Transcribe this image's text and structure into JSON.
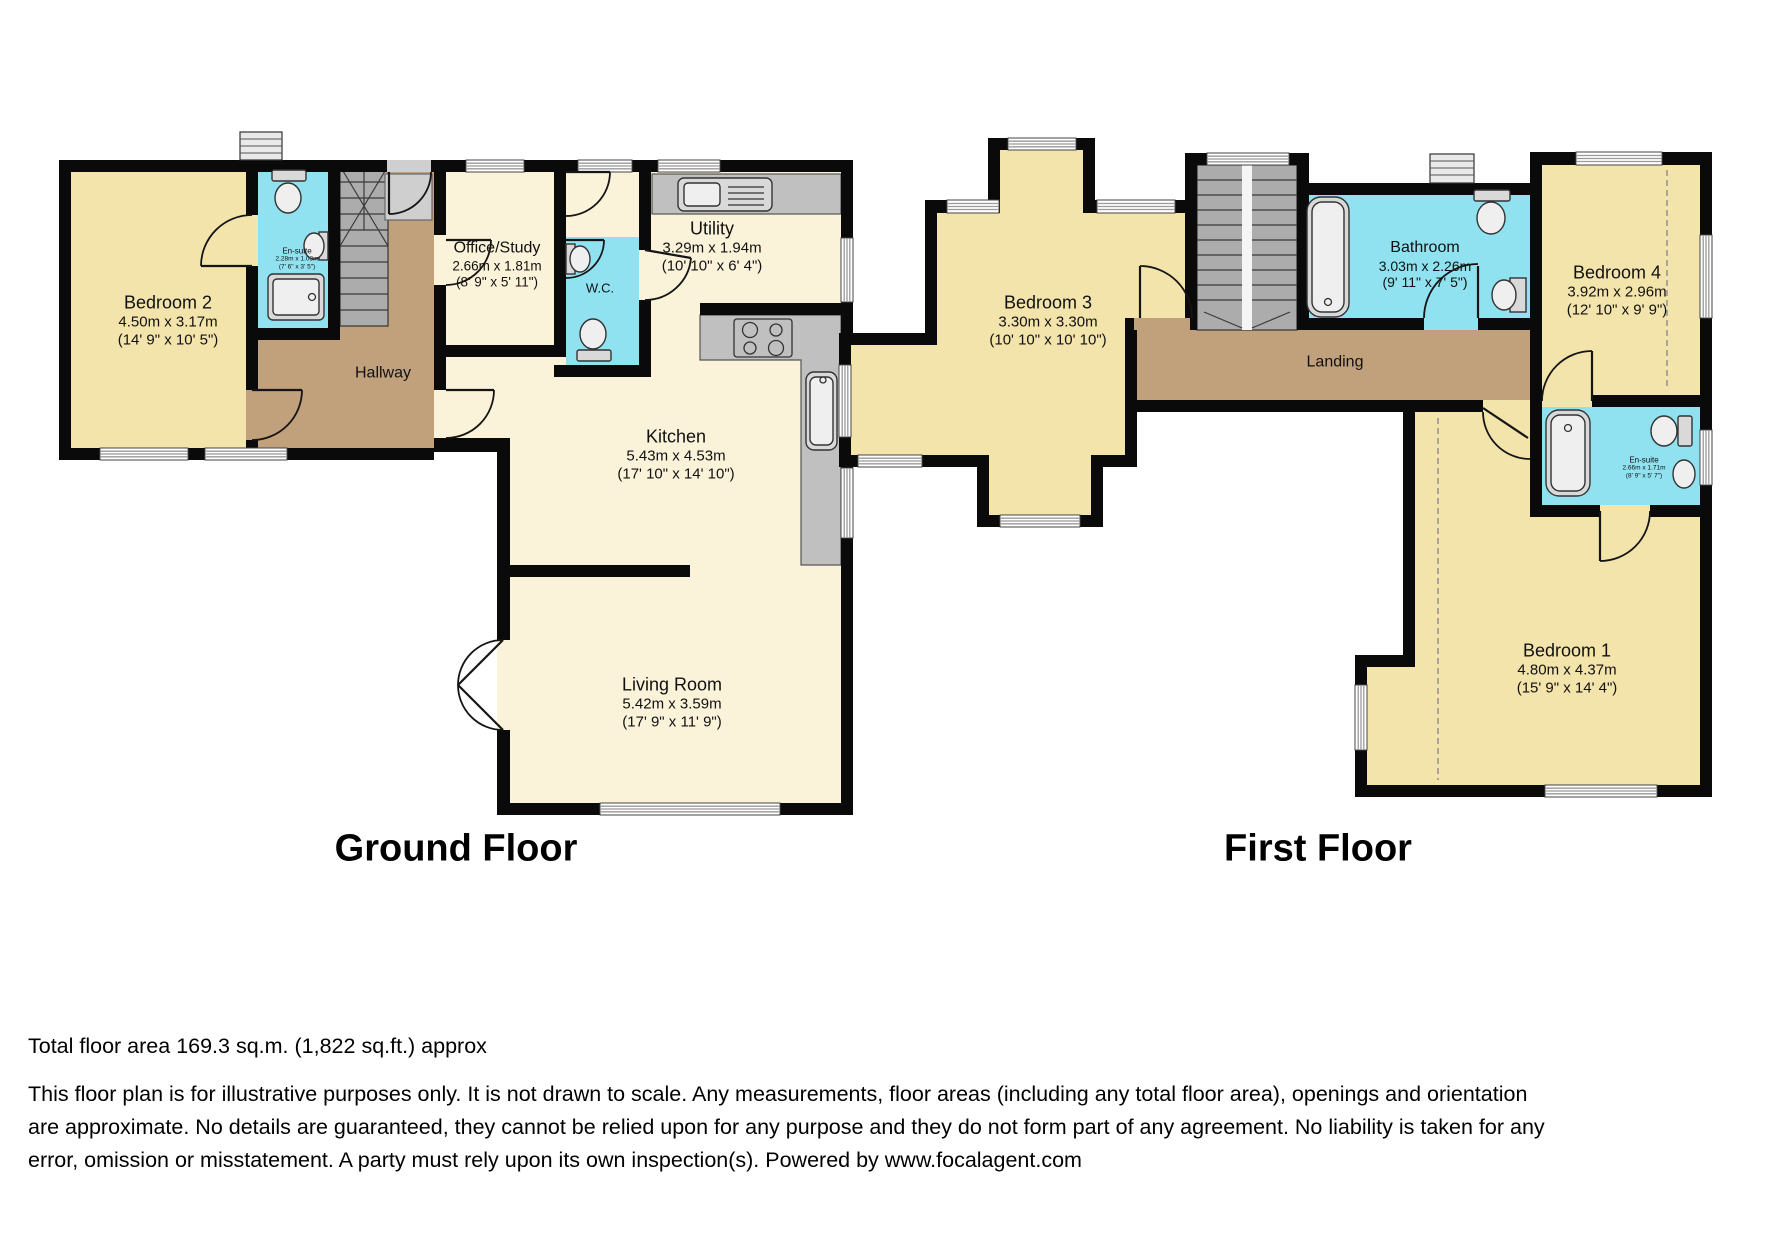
{
  "floors": [
    {
      "id": "ground",
      "title": "Ground Floor",
      "rooms": [
        {
          "name": "Bedroom 2",
          "metric": "4.50m x 3.17m",
          "imperial": "(14' 9\" x 10' 5\")"
        },
        {
          "name": "En-suite",
          "metric": "2.28m x 1.03m",
          "imperial": "(7' 6\" x 3' 5\")"
        },
        {
          "name": "Hallway",
          "metric": "",
          "imperial": ""
        },
        {
          "name": "Office/Study",
          "metric": "2.66m x 1.81m",
          "imperial": "(8' 9\" x 5' 11\")"
        },
        {
          "name": "W.C.",
          "metric": "",
          "imperial": ""
        },
        {
          "name": "Utility",
          "metric": "3.29m x 1.94m",
          "imperial": "(10' 10\" x 6' 4\")"
        },
        {
          "name": "Kitchen",
          "metric": "5.43m x 4.53m",
          "imperial": "(17' 10\" x 14' 10\")"
        },
        {
          "name": "Living Room",
          "metric": "5.42m x 3.59m",
          "imperial": "(17' 9\" x 11' 9\")"
        }
      ]
    },
    {
      "id": "first",
      "title": "First Floor",
      "rooms": [
        {
          "name": "Bedroom 3",
          "metric": "3.30m x 3.30m",
          "imperial": "(10' 10\" x 10' 10\")"
        },
        {
          "name": "Bathroom",
          "metric": "3.03m x 2.26m",
          "imperial": "(9' 11\" x 7' 5\")"
        },
        {
          "name": "Bedroom 4",
          "metric": "3.92m x 2.96m",
          "imperial": "(12' 10\" x 9' 9\")"
        },
        {
          "name": "Landing",
          "metric": "",
          "imperial": ""
        },
        {
          "name": "En-suite",
          "metric": "2.66m x 1.71m",
          "imperial": "(8' 9\" x 5' 7\")"
        },
        {
          "name": "Bedroom 1",
          "metric": "4.80m x 4.37m",
          "imperial": "(15' 9\" x 14' 4\")"
        }
      ]
    }
  ],
  "footer": {
    "total_area": "Total floor area 169.3 sq.m. (1,822 sq.ft.) approx",
    "disclaimer": "This floor plan is for illustrative purposes only. It is not drawn to scale. Any measurements, floor areas (including any total floor area), openings and orientation are approximate. No details are guaranteed, they cannot be relied upon for any purpose and they do not form part of any agreement. No liability is taken for any error, omission or misstatement. A party must rely upon its own inspection(s). Powered by www.focalagent.com"
  },
  "colors": {
    "bedroom_fill": "#F3E4AB",
    "living_fill": "#FAF3DA",
    "wet_room_fill": "#90E2F0",
    "hall_fill": "#C1A07C",
    "wall": "#0A0A0A"
  }
}
